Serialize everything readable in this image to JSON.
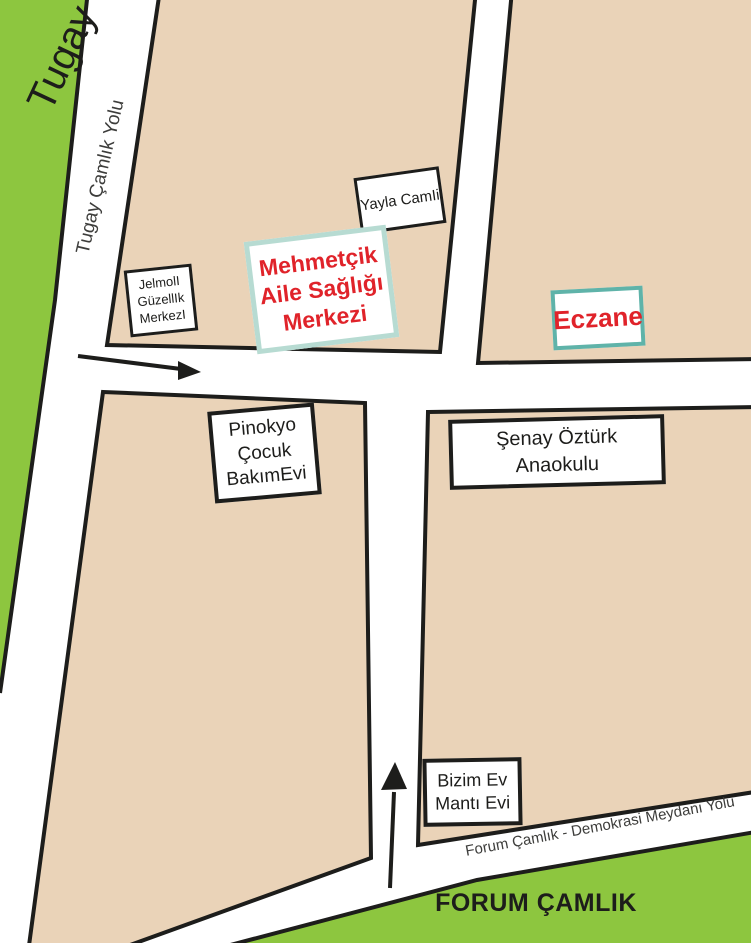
{
  "map": {
    "areas": {
      "tugay": {
        "label": "Tugay"
      },
      "forum_camlik": {
        "label": "FORUM ÇAMLIK"
      }
    },
    "roads": {
      "tugay_camlik_yolu": {
        "label": "Tugay Çamlık Yolu"
      },
      "forum_demokrasi_yolu": {
        "label": "Forum Çamlık - Demokrasi Meydanı Yolu"
      }
    },
    "arrows": [
      {
        "icon": "arrow-east-icon",
        "direction": "east"
      },
      {
        "icon": "arrow-north-icon",
        "direction": "north"
      }
    ],
    "places": {
      "yayla_camii": {
        "lines": [
          "Yayla CamIi"
        ]
      },
      "mehmetcik_asm": {
        "lines": [
          "Mehmetçik",
          "Aile Sağlığı",
          "Merkezi"
        ]
      },
      "jelmoli": {
        "lines": [
          "JelmolI",
          "GüzellIk",
          "MerkezI"
        ]
      },
      "eczane": {
        "lines": [
          "Eczane"
        ]
      },
      "pinokyo": {
        "lines": [
          "Pinokyo",
          "Çocuk",
          "BakımEvi"
        ]
      },
      "senay_ozturk": {
        "lines": [
          "Şenay Öztürk",
          "Anaokulu"
        ]
      },
      "bizim_ev": {
        "lines": [
          "Bizim Ev",
          "Mantı Evi"
        ]
      }
    },
    "colors": {
      "block_fill": "#ead3b8",
      "green_fill": "#8dc63f",
      "road_fill": "#ffffff",
      "outline": "#1d1d1b",
      "poi_red": "#e0232a",
      "mehmetcik_border": "#b7dbd2",
      "eczane_border": "#5fb3a9"
    }
  }
}
